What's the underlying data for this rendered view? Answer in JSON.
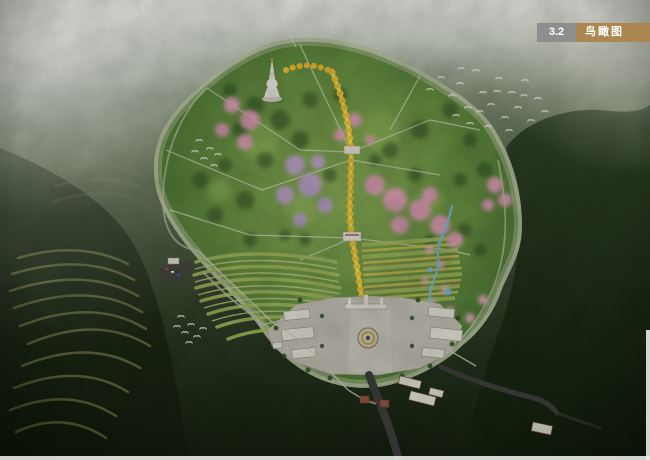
{
  "section_tag": {
    "number": "3.2",
    "title": "鸟瞰图",
    "number_bg": "#8e8e8e",
    "title_bg": "#aa8750",
    "text_color": "#ffffff"
  },
  "colors": {
    "haze": "#f5f7f2",
    "forest_dark": "#1b2a16",
    "hill_mid": "#55684a",
    "park_green": "#6f9a48",
    "hedge_green": "#2c4a23",
    "axis_gold": "#f0c332",
    "axis_gold_deep": "#c89a1e",
    "blossom_pink": "#eba2c2",
    "blossom_pink_light": "#efaecb",
    "blossom_lavender": "#c7a8dc",
    "terrace_row": "#aabf60",
    "terrace_row_light": "#ccd685",
    "flower_row_gold": "#d2c253",
    "flower_row_red": "#c26a5a",
    "farm_terrace": "#7c7f49",
    "plaza_paving": "#cac7bc",
    "building_roof": "#edebdf",
    "building_wall_red": "#9b5a48",
    "road_asphalt": "#414140",
    "boundary_road": "#c2c8ac",
    "water_blue": "#7fbcd4",
    "wall_light": "#d5d0bd",
    "bird_white": "#ffffff",
    "pagoda_white": "#f7f5ee",
    "pagoda_spire_gold": "#d9a520",
    "emblem_gold": "#c09a40"
  },
  "scene": {
    "features": [
      {
        "id": "dark-forest-hills"
      },
      {
        "id": "sun-glare-haze"
      },
      {
        "id": "farm-terraces"
      },
      {
        "id": "park-site"
      },
      {
        "id": "hedge-grid"
      },
      {
        "id": "path-network"
      },
      {
        "id": "terraced-garden-rows"
      },
      {
        "id": "flower-bed-rows"
      },
      {
        "id": "lavender-blossom-grove"
      },
      {
        "id": "pink-blossom-grove"
      },
      {
        "id": "golden-tree-axis"
      },
      {
        "id": "axis-monuments"
      },
      {
        "id": "white-pagoda"
      },
      {
        "id": "stream-and-ponds"
      },
      {
        "id": "entrance-plaza"
      },
      {
        "id": "plaza-emblem"
      },
      {
        "id": "plaza-gate"
      },
      {
        "id": "white-roof-buildings"
      },
      {
        "id": "gatehouses"
      },
      {
        "id": "exit-road"
      },
      {
        "id": "perimeter-wall"
      },
      {
        "id": "parking-lot"
      },
      {
        "id": "bird-flocks"
      }
    ]
  }
}
